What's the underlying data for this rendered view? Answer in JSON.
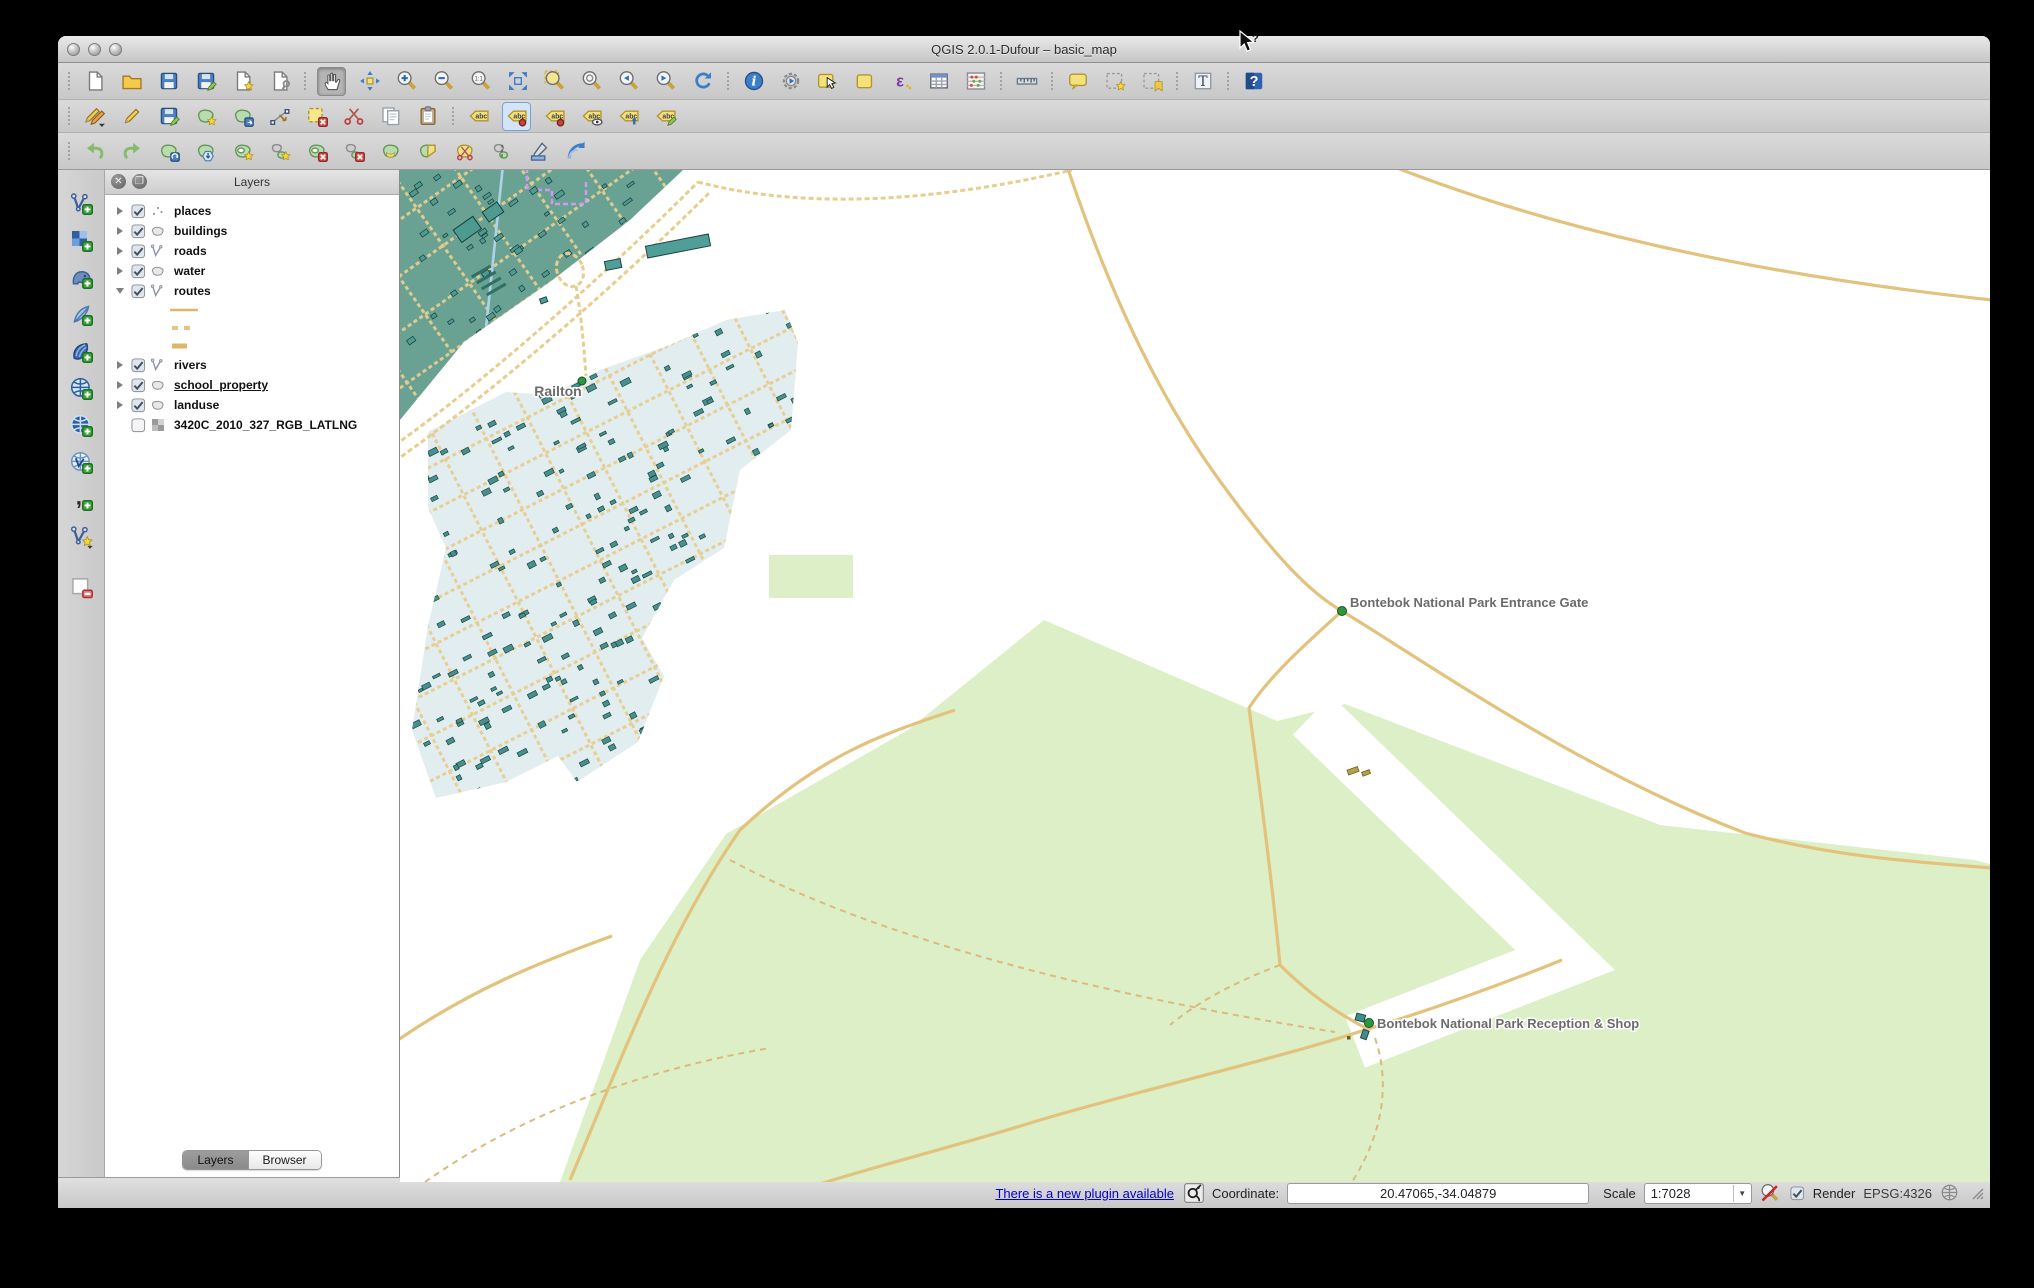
{
  "window": {
    "title": "QGIS 2.0.1-Dufour – basic_map"
  },
  "titlebar_buttons": [
    {
      "name": "close-button"
    },
    {
      "name": "minimize-button"
    },
    {
      "name": "zoom-button"
    }
  ],
  "toolbar_row1": [
    {
      "name": "new-project",
      "icon": "doc",
      "sep": true
    },
    {
      "name": "open-project",
      "icon": "folder"
    },
    {
      "name": "save-project",
      "icon": "floppy"
    },
    {
      "name": "save-project-as",
      "icon": "floppyedit"
    },
    {
      "name": "new-print-composer",
      "icon": "docstar"
    },
    {
      "name": "composer-manager",
      "icon": "docwrench"
    },
    {
      "name": "pan-map",
      "icon": "hand",
      "active": "gray",
      "sep": true
    },
    {
      "name": "pan-to-selection",
      "icon": "cross"
    },
    {
      "name": "zoom-in",
      "icon": "magplus"
    },
    {
      "name": "zoom-out",
      "icon": "magminus"
    },
    {
      "name": "zoom-actual-size",
      "icon": "mag11"
    },
    {
      "name": "zoom-full-extent",
      "icon": "fullext"
    },
    {
      "name": "zoom-to-layer",
      "icon": "magyellow"
    },
    {
      "name": "zoom-to-selection",
      "icon": "magsel"
    },
    {
      "name": "zoom-last",
      "icon": "maglast"
    },
    {
      "name": "zoom-next",
      "icon": "magnext"
    },
    {
      "name": "refresh-map",
      "icon": "refresh"
    },
    {
      "name": "identify-features",
      "icon": "info",
      "sep": true
    },
    {
      "name": "run-feature-action",
      "icon": "gear"
    },
    {
      "name": "select-features",
      "icon": "select"
    },
    {
      "name": "deselect-features",
      "icon": "deselect"
    },
    {
      "name": "select-by-expression",
      "icon": "epsilon"
    },
    {
      "name": "open-attribute-table",
      "icon": "table"
    },
    {
      "name": "field-calculator",
      "icon": "abacus"
    },
    {
      "name": "measure-line",
      "icon": "ruler",
      "sep": true
    },
    {
      "name": "map-tips",
      "icon": "maptip",
      "sep": true
    },
    {
      "name": "new-bookmark",
      "icon": "bookmarknew"
    },
    {
      "name": "show-bookmarks",
      "icon": "bookmarkshow"
    },
    {
      "name": "text-annotation",
      "icon": "textT",
      "sep": true
    },
    {
      "name": "help-contents",
      "icon": "help",
      "sep": true
    }
  ],
  "toolbar_row2": [
    {
      "name": "current-edits",
      "icon": "pencils",
      "sep": true
    },
    {
      "name": "toggle-editing",
      "icon": "pencil"
    },
    {
      "name": "save-layer-edits",
      "icon": "floppyedit"
    },
    {
      "name": "add-feature",
      "icon": "blobstar"
    },
    {
      "name": "move-feature",
      "icon": "blobarrow"
    },
    {
      "name": "node-tool",
      "icon": "node"
    },
    {
      "name": "delete-selected",
      "icon": "delsel"
    },
    {
      "name": "cut-features",
      "icon": "scissors"
    },
    {
      "name": "copy-features",
      "icon": "copy"
    },
    {
      "name": "paste-features",
      "icon": "clipboard"
    },
    {
      "name": "layer-labeling-options",
      "icon": "tag",
      "sep": true
    },
    {
      "name": "pin-unpin-labels",
      "icon": "tagpin",
      "active": "blue"
    },
    {
      "name": "highlight-pinned-labels",
      "icon": "tagpin"
    },
    {
      "name": "show-hide-labels",
      "icon": "tageye"
    },
    {
      "name": "move-label",
      "icon": "tagarrow"
    },
    {
      "name": "change-label-properties",
      "icon": "tagedit"
    }
  ],
  "toolbar_row3": [
    {
      "name": "undo",
      "icon": "undo",
      "sep": true
    },
    {
      "name": "redo",
      "icon": "redo"
    },
    {
      "name": "rotate-feature",
      "icon": "blobrotate"
    },
    {
      "name": "simplify-feature",
      "icon": "blobsimplify"
    },
    {
      "name": "add-ring",
      "icon": "ringstar"
    },
    {
      "name": "add-part",
      "icon": "partstar"
    },
    {
      "name": "delete-ring",
      "icon": "ringx"
    },
    {
      "name": "delete-part",
      "icon": "partx"
    },
    {
      "name": "fill-ring",
      "icon": "ringfill"
    },
    {
      "name": "reshape-features",
      "icon": "reshape"
    },
    {
      "name": "split-features",
      "icon": "splitf"
    },
    {
      "name": "merge-features",
      "icon": "mergef"
    },
    {
      "name": "rotate-point-symbols",
      "icon": "rotpoint"
    },
    {
      "name": "offset-curve",
      "icon": "offsetc"
    }
  ],
  "left_toolbar": [
    {
      "name": "add-vector-layer",
      "icon": "vplus"
    },
    {
      "name": "add-raster-layer",
      "icon": "checker"
    },
    {
      "name": "add-postgis-layer",
      "icon": "elephant"
    },
    {
      "name": "add-spatialite-layer",
      "icon": "feather"
    },
    {
      "name": "add-mssql-layer",
      "icon": "shell"
    },
    {
      "name": "add-wms-layer",
      "icon": "globeL"
    },
    {
      "name": "add-wcs-layer",
      "icon": "globeD"
    },
    {
      "name": "add-wfs-layer",
      "icon": "globeV"
    },
    {
      "name": "add-delimited-text-layer",
      "icon": "comma"
    },
    {
      "name": "new-shapefile-layer",
      "icon": "newshp"
    },
    {
      "name": "remove-layer",
      "icon": "removelayer",
      "sep": true
    }
  ],
  "layers_panel": {
    "title": "Layers",
    "layers": [
      {
        "label": "places",
        "checked": true,
        "icon": "points"
      },
      {
        "label": "buildings",
        "checked": true,
        "icon": "polygon"
      },
      {
        "label": "roads",
        "checked": true,
        "icon": "line"
      },
      {
        "label": "water",
        "checked": true,
        "icon": "polygon"
      },
      {
        "label": "routes",
        "checked": true,
        "icon": "line",
        "expanded": true,
        "children": [
          "solid",
          "dashes",
          "dash"
        ]
      },
      {
        "label": "rivers",
        "checked": true,
        "icon": "line"
      },
      {
        "label": "school_property",
        "checked": true,
        "icon": "polygon",
        "underline": true
      },
      {
        "label": "landuse",
        "checked": true,
        "icon": "polygon"
      },
      {
        "label": "3420C_2010_327_RGB_LATLNG",
        "checked": false,
        "icon": "raster",
        "leaf": true
      }
    ],
    "tabs": [
      {
        "label": "Layers",
        "active": true
      },
      {
        "label": "Browser",
        "active": false
      }
    ]
  },
  "map": {
    "labels": {
      "town": "Railton",
      "gate": "Bontebok National Park Entrance Gate",
      "reception": "Bontebok National Park Reception & Shop"
    },
    "colors": {
      "teal_landuse": "#69a293",
      "residential": "#e2edf0",
      "park": "#dcefc7",
      "road": "#e7cd8e",
      "road_solid": "#e2c27c",
      "building": "#47908c",
      "building_dark": "#1c4947",
      "river": "#aed3e8",
      "route_violet": "#cf9bf2",
      "label_gray": "#6b6b6b",
      "marker_green": "#2f9640"
    }
  },
  "status_bar": {
    "plugin_link": "There is a new plugin available",
    "coordinate_label": "Coordinate:",
    "coordinate_value": "20.47065,-34.04879",
    "scale_label": "Scale",
    "scale_value": "1:7028",
    "render_label": "Render",
    "crs_label": "EPSG:4326"
  }
}
